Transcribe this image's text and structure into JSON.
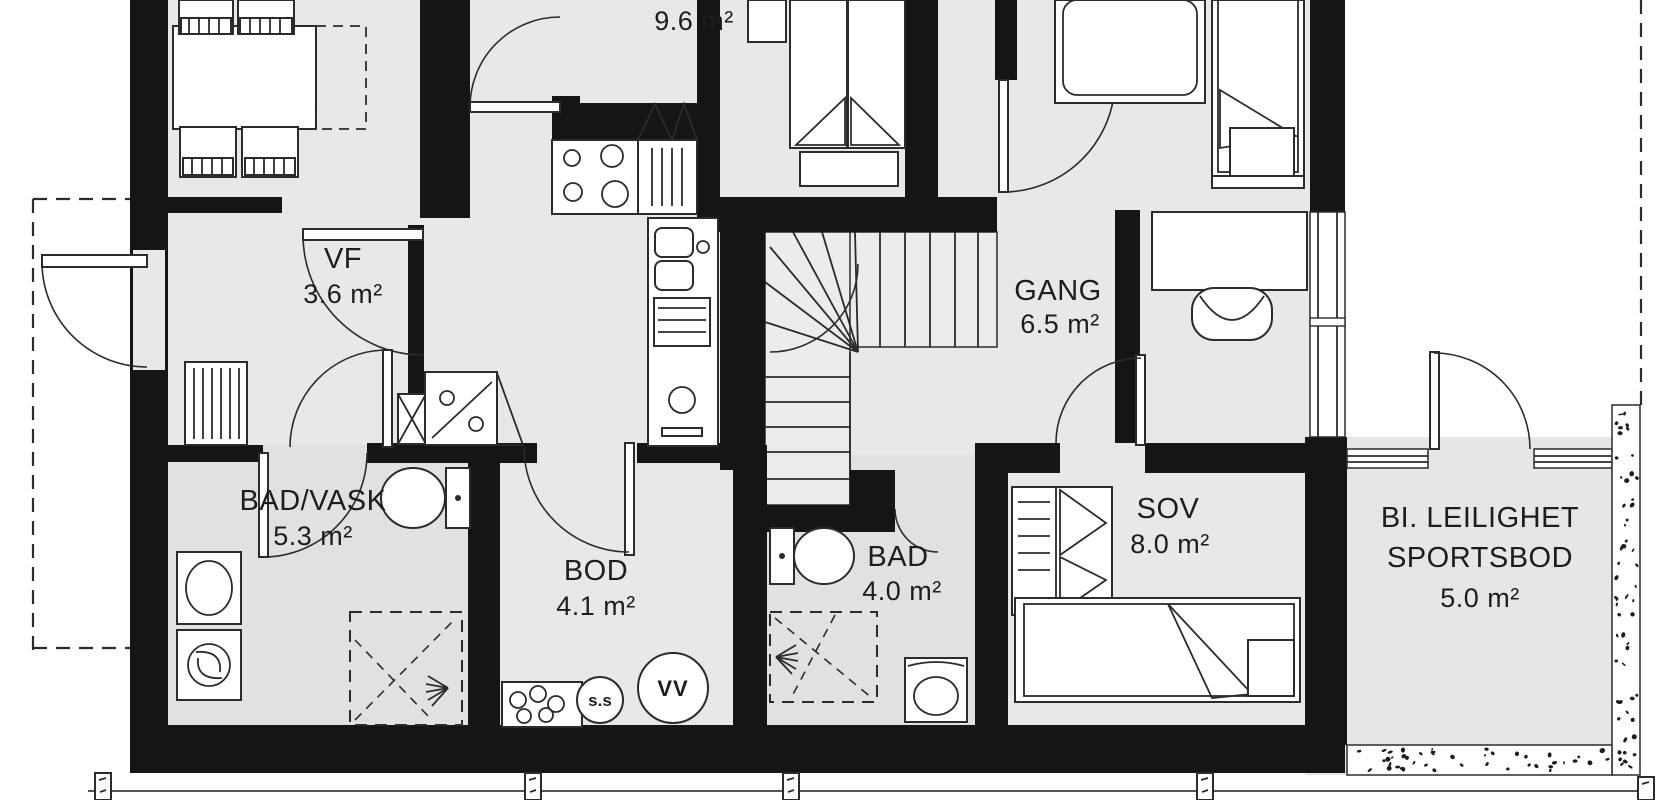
{
  "plan": {
    "type": "floor-plan",
    "language": "Norwegian",
    "colors": {
      "wall": "#151515",
      "floor": "#e9e8e6",
      "bath_floor": "#e2e1df",
      "background": "#ffffff",
      "line": "#2b2b2b",
      "text": "#1d1d1d"
    }
  },
  "rooms": [
    {
      "id": "kitchen-living",
      "name": "",
      "area": "9.6 m²"
    },
    {
      "id": "vf",
      "name": "VF",
      "area": "3.6 m²"
    },
    {
      "id": "gang",
      "name": "GANG",
      "area": "6.5 m²"
    },
    {
      "id": "bad-vask",
      "name": "BAD/VASK",
      "area": "5.3 m²"
    },
    {
      "id": "bod",
      "name": "BOD",
      "area": "4.1 m²"
    },
    {
      "id": "bad",
      "name": "BAD",
      "area": "4.0 m²"
    },
    {
      "id": "sov",
      "name": "SOV",
      "area": "8.0 m²"
    },
    {
      "id": "sportsbod",
      "name_line1": "BI. LEILIGHET",
      "name_line2": "SPORTSBOD",
      "area": "5.0 m²"
    }
  ],
  "symbols": {
    "water_heater": "VV",
    "floor_drain": "s.s"
  }
}
